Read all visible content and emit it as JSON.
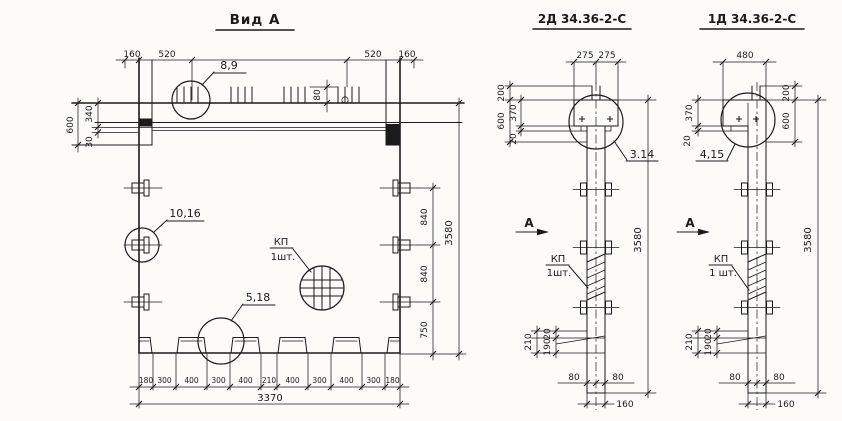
{
  "drawing": {
    "view_a": {
      "title": "Вид А",
      "callout_8_9": "8,9",
      "callout_10_16": "10,16",
      "callout_5_18": "5,18",
      "kp_label": "КП",
      "kp_qty": "1шт.",
      "dim_160_l": "160",
      "dim_520_l": "520",
      "dim_520_r": "520",
      "dim_160_r": "160",
      "dim_80": "80",
      "dim_600": "600",
      "dim_340": "340",
      "dim_30": "30",
      "dim_840_a": "840",
      "dim_840_b": "840",
      "dim_750": "750",
      "dim_3580": "3580",
      "bottom": [
        "180",
        "300",
        "400",
        "300",
        "400",
        "210",
        "400",
        "300",
        "400",
        "300",
        "180"
      ],
      "dim_3370": "3370"
    },
    "section_2d": {
      "title": "2Д 34.36-2-С",
      "dim_275_l": "275",
      "dim_275_r": "275",
      "dim_200": "200",
      "dim_600": "600",
      "dim_370": "370",
      "dim_20": "20",
      "callout_pos": "3.14",
      "section_letter": "А",
      "kp_label": "КП",
      "kp_qty": "1шт.",
      "dim_3580": "3580",
      "dim_210": "210",
      "dim_190": "190",
      "dim_20b": "20",
      "dim_80_l": "80",
      "dim_80_r": "80",
      "dim_160": "160"
    },
    "section_1d": {
      "title": "1Д 34.36-2-С",
      "dim_480": "480",
      "dim_200": "200",
      "dim_600": "600",
      "dim_370": "370",
      "dim_20": "20",
      "callout_pos": "4,15",
      "section_letter": "А",
      "kp_label": "КП",
      "kp_qty": "1 шт.",
      "dim_3580": "3580",
      "dim_210": "210",
      "dim_190": "190",
      "dim_20b": "20",
      "dim_80_l": "80",
      "dim_80_r": "80",
      "dim_160": "160"
    }
  }
}
